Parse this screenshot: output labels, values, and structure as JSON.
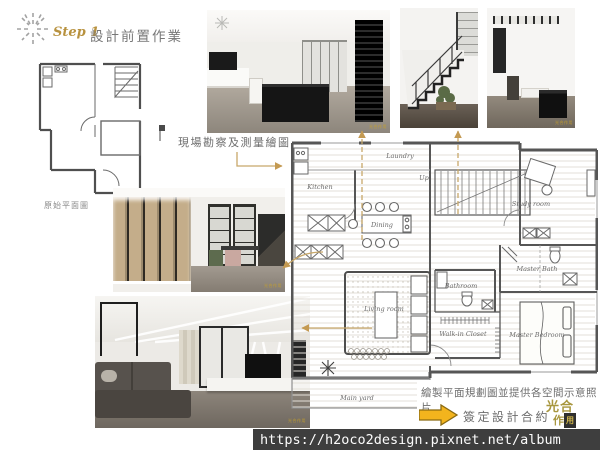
{
  "slide": {
    "step_label": "Step 1",
    "title": "設計前置作業"
  },
  "left_sketch": {
    "caption": "原始平面圖"
  },
  "callouts": {
    "survey": "現場勘察及測量繪圖",
    "plan_note": "繪製平面規劃圖並提供各空間示意照片",
    "contract": "簽定設計合約"
  },
  "floor_plan": {
    "labels": {
      "kitchen": "Kitchen",
      "laundry": "Laundry",
      "up": "Up",
      "study": "Study room",
      "dining": "Dining",
      "living": "Living room",
      "bathroom": "Bathroom",
      "closet": "Walk-in Closet",
      "master_bath": "Master Bath",
      "master_bed": "Master Bedroom",
      "yard": "Main yard"
    }
  },
  "photos": {
    "watermark": "光合作用"
  },
  "logo": {
    "line1": "光合",
    "line2_char": "作",
    "line2_boxed": "用"
  },
  "footer": {
    "url": "https://h2oco2design.pixnet.net/album"
  },
  "colors": {
    "accent_gold": "#c8a86a",
    "step_gold": "#b8923f",
    "arrow_yellow": "#f3b41d",
    "text_gray": "#6e6e6e",
    "url_bar": "#3e3e3e",
    "plan_wall": "#565656"
  }
}
